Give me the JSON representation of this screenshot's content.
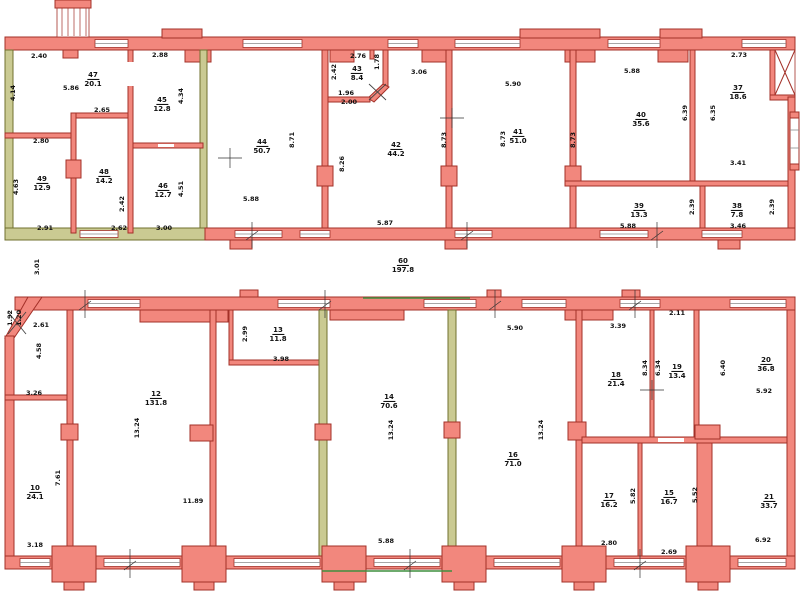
{
  "drawing_title": "Two-wing building floor plan",
  "colors": {
    "wall": "#F2877D",
    "wallEdge": "#A33028",
    "olive": "#CACA92",
    "oliveEdge": "#70702F",
    "green": "#3F8F3F",
    "ink": "#111111",
    "paper": "#FFFFFF"
  },
  "floors": [
    {
      "id": "upper-wing",
      "rooms": [
        {
          "n": "47",
          "a": "20.1",
          "x": 93,
          "y": 76
        },
        {
          "n": "45",
          "a": "12.8",
          "x": 162,
          "y": 101
        },
        {
          "n": "49",
          "a": "12.9",
          "x": 42,
          "y": 180
        },
        {
          "n": "48",
          "a": "14.2",
          "x": 104,
          "y": 173
        },
        {
          "n": "46",
          "a": "12.7",
          "x": 163,
          "y": 187
        },
        {
          "n": "44",
          "a": "50.7",
          "x": 262,
          "y": 143
        },
        {
          "n": "43",
          "a": "8.4",
          "x": 357,
          "y": 70
        },
        {
          "n": "42",
          "a": "44.2",
          "x": 396,
          "y": 146
        },
        {
          "n": "41",
          "a": "51.0",
          "x": 518,
          "y": 133
        },
        {
          "n": "40",
          "a": "35.6",
          "x": 641,
          "y": 116
        },
        {
          "n": "39",
          "a": "13.3",
          "x": 639,
          "y": 207
        },
        {
          "n": "38",
          "a": "7.8",
          "x": 737,
          "y": 207
        },
        {
          "n": "37",
          "a": "18.6",
          "x": 738,
          "y": 89
        },
        {
          "n": "60",
          "a": "197.8",
          "x": 403,
          "y": 262
        }
      ],
      "dims": [
        {
          "t": "2.40",
          "x": 39,
          "y": 56,
          "v": false
        },
        {
          "t": "5.86",
          "x": 71,
          "y": 88,
          "v": false
        },
        {
          "t": "2.88",
          "x": 160,
          "y": 55,
          "v": false
        },
        {
          "t": "4.14",
          "x": 13,
          "y": 93,
          "v": true
        },
        {
          "t": "4.34",
          "x": 181,
          "y": 96,
          "v": true
        },
        {
          "t": "2.65",
          "x": 102,
          "y": 110,
          "v": false
        },
        {
          "t": "2.80",
          "x": 41,
          "y": 141,
          "v": false
        },
        {
          "t": "4.63",
          "x": 16,
          "y": 187,
          "v": true
        },
        {
          "t": "2.42",
          "x": 122,
          "y": 204,
          "v": true
        },
        {
          "t": "4.51",
          "x": 181,
          "y": 189,
          "v": true
        },
        {
          "t": "2.91",
          "x": 45,
          "y": 228,
          "v": false
        },
        {
          "t": "2.62",
          "x": 119,
          "y": 228,
          "v": false
        },
        {
          "t": "3.00",
          "x": 164,
          "y": 228,
          "v": false
        },
        {
          "t": "8.71",
          "x": 292,
          "y": 140,
          "v": true
        },
        {
          "t": "5.88",
          "x": 251,
          "y": 199,
          "v": false
        },
        {
          "t": "2.76",
          "x": 358,
          "y": 56,
          "v": false
        },
        {
          "t": "2.42",
          "x": 334,
          "y": 72,
          "v": true
        },
        {
          "t": "1.78",
          "x": 377,
          "y": 62,
          "v": true
        },
        {
          "t": "1.96",
          "x": 346,
          "y": 93,
          "v": false
        },
        {
          "t": "2.00",
          "x": 349,
          "y": 102,
          "v": false
        },
        {
          "t": "3.06",
          "x": 419,
          "y": 72,
          "v": false
        },
        {
          "t": "8.26",
          "x": 342,
          "y": 164,
          "v": true
        },
        {
          "t": "8.73",
          "x": 444,
          "y": 140,
          "v": true
        },
        {
          "t": "5.87",
          "x": 385,
          "y": 223,
          "v": false
        },
        {
          "t": "8.73",
          "x": 503,
          "y": 139,
          "v": true
        },
        {
          "t": "5.90",
          "x": 513,
          "y": 84,
          "v": false
        },
        {
          "t": "8.73",
          "x": 573,
          "y": 140,
          "v": true
        },
        {
          "t": "5.88",
          "x": 632,
          "y": 71,
          "v": false
        },
        {
          "t": "5.88",
          "x": 628,
          "y": 226,
          "v": false
        },
        {
          "t": "2.39",
          "x": 692,
          "y": 207,
          "v": true
        },
        {
          "t": "3.46",
          "x": 738,
          "y": 226,
          "v": false
        },
        {
          "t": "2.39",
          "x": 772,
          "y": 207,
          "v": true
        },
        {
          "t": "2.73",
          "x": 739,
          "y": 55,
          "v": false
        },
        {
          "t": "3.41",
          "x": 738,
          "y": 163,
          "v": false
        },
        {
          "t": "6.39",
          "x": 685,
          "y": 113,
          "v": true
        },
        {
          "t": "6.35",
          "x": 713,
          "y": 113,
          "v": true
        },
        {
          "t": "3.01",
          "x": 37,
          "y": 267,
          "v": true
        }
      ]
    },
    {
      "id": "lower-wing",
      "rooms": [
        {
          "n": "13",
          "a": "11.8",
          "x": 278,
          "y": 331
        },
        {
          "n": "12",
          "a": "131.8",
          "x": 156,
          "y": 395
        },
        {
          "n": "14",
          "a": "70.6",
          "x": 389,
          "y": 398
        },
        {
          "n": "16",
          "a": "71.0",
          "x": 513,
          "y": 456
        },
        {
          "n": "18",
          "a": "21.4",
          "x": 616,
          "y": 376
        },
        {
          "n": "19",
          "a": "13.4",
          "x": 677,
          "y": 368
        },
        {
          "n": "20",
          "a": "36.8",
          "x": 766,
          "y": 361
        },
        {
          "n": "10",
          "a": "24.1",
          "x": 35,
          "y": 489
        },
        {
          "n": "17",
          "a": "16.2",
          "x": 609,
          "y": 497
        },
        {
          "n": "15",
          "a": "16.7",
          "x": 669,
          "y": 494
        },
        {
          "n": "21",
          "a": "33.7",
          "x": 769,
          "y": 498
        }
      ],
      "dims": [
        {
          "t": "1.92",
          "x": 10,
          "y": 318,
          "v": true
        },
        {
          "t": "1.20",
          "x": 19,
          "y": 318,
          "v": true
        },
        {
          "t": "2.61",
          "x": 41,
          "y": 325,
          "v": false
        },
        {
          "t": "4.58",
          "x": 39,
          "y": 351,
          "v": true
        },
        {
          "t": "3.26",
          "x": 34,
          "y": 393,
          "v": false
        },
        {
          "t": "7.61",
          "x": 58,
          "y": 478,
          "v": true
        },
        {
          "t": "3.18",
          "x": 35,
          "y": 545,
          "v": false
        },
        {
          "t": "13.24",
          "x": 137,
          "y": 428,
          "v": true
        },
        {
          "t": "11.89",
          "x": 193,
          "y": 501,
          "v": false
        },
        {
          "t": "2.99",
          "x": 245,
          "y": 334,
          "v": true
        },
        {
          "t": "3.98",
          "x": 281,
          "y": 359,
          "v": false
        },
        {
          "t": "13.24",
          "x": 391,
          "y": 430,
          "v": true
        },
        {
          "t": "5.88",
          "x": 386,
          "y": 541,
          "v": false
        },
        {
          "t": "5.90",
          "x": 515,
          "y": 328,
          "v": false
        },
        {
          "t": "13.24",
          "x": 541,
          "y": 430,
          "v": true
        },
        {
          "t": "3.39",
          "x": 618,
          "y": 326,
          "v": false
        },
        {
          "t": "8.34",
          "x": 645,
          "y": 368,
          "v": true
        },
        {
          "t": "6.34",
          "x": 658,
          "y": 368,
          "v": true
        },
        {
          "t": "2.11",
          "x": 677,
          "y": 313,
          "v": false
        },
        {
          "t": "6.40",
          "x": 723,
          "y": 368,
          "v": true
        },
        {
          "t": "5.92",
          "x": 764,
          "y": 391,
          "v": false
        },
        {
          "t": "5.82",
          "x": 633,
          "y": 496,
          "v": true
        },
        {
          "t": "2.80",
          "x": 609,
          "y": 543,
          "v": false
        },
        {
          "t": "5.52",
          "x": 695,
          "y": 495,
          "v": true
        },
        {
          "t": "2.69",
          "x": 669,
          "y": 552,
          "v": false
        },
        {
          "t": "6.92",
          "x": 763,
          "y": 540,
          "v": false
        }
      ]
    }
  ]
}
